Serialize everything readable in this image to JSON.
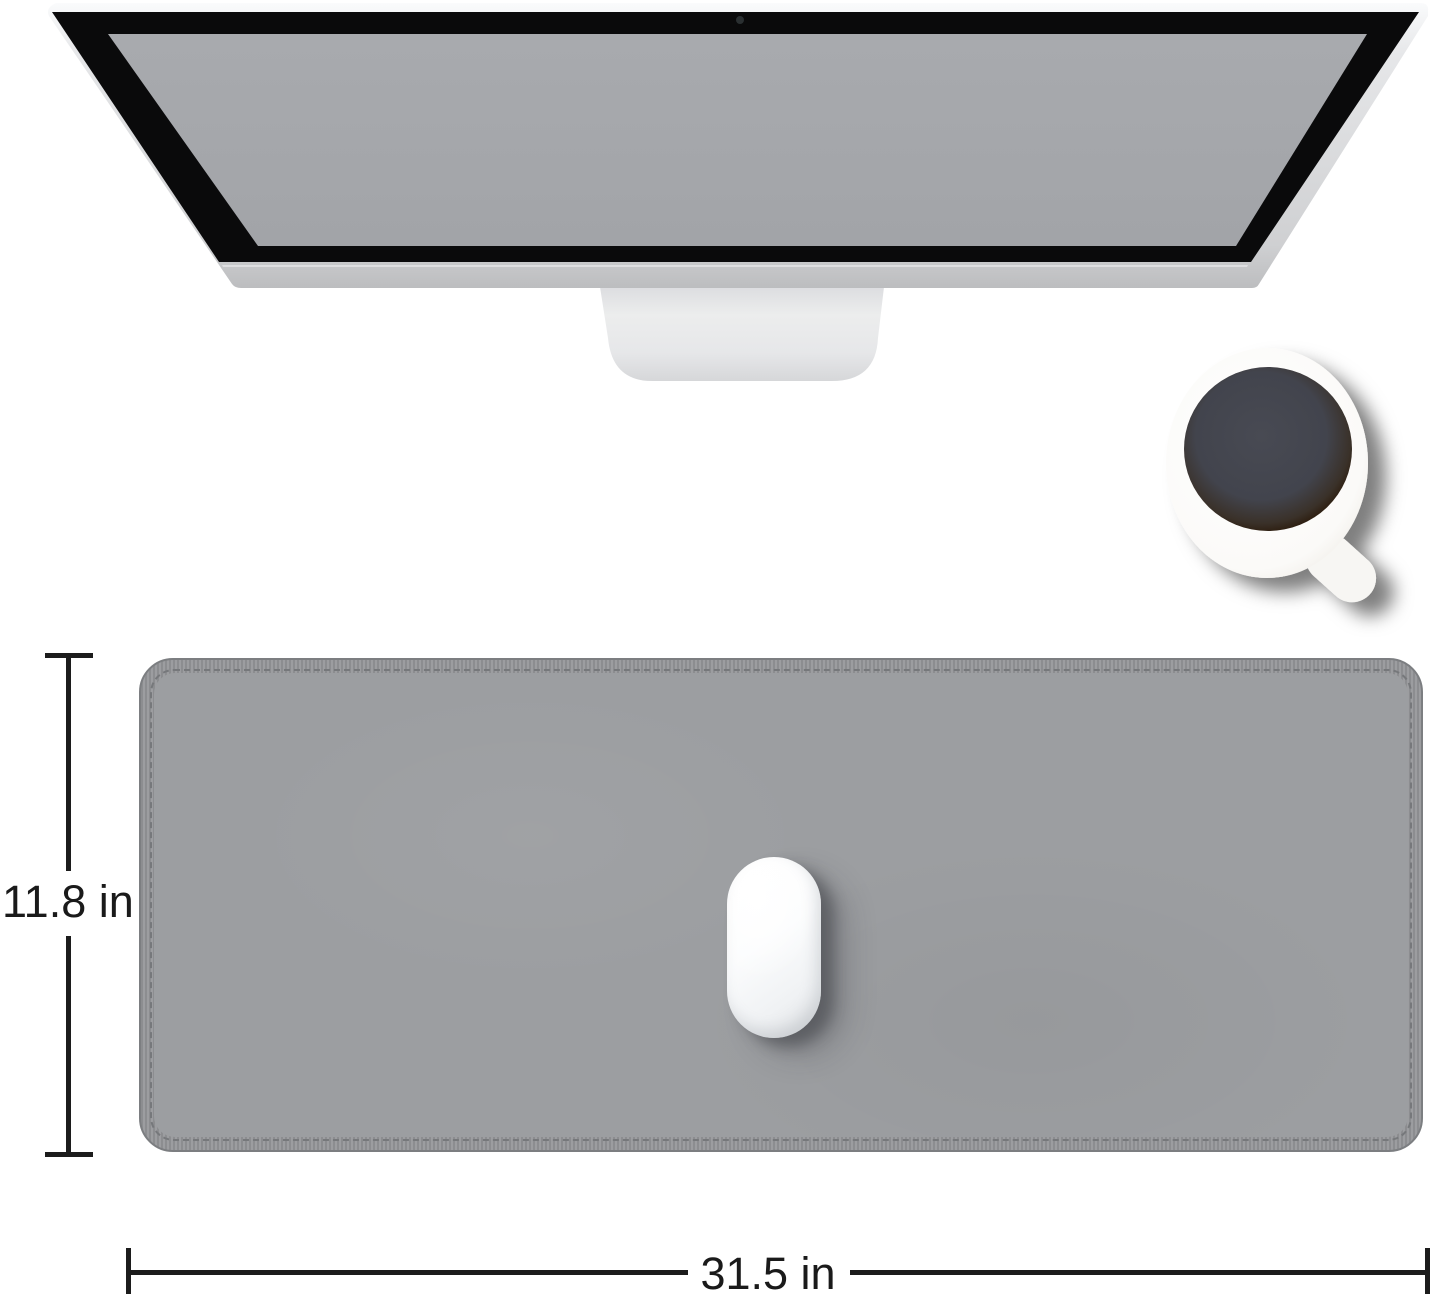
{
  "annotations": {
    "height_label": "11.8 in",
    "width_label": "31.5 in"
  },
  "colors": {
    "background": "#ffffff",
    "dimension_line": "#1c1c1c",
    "label_text": "#1a1a1a",
    "pad_surface": "#9c9ea1",
    "pad_band": "#97989b",
    "pad_edge": "#7c7e81",
    "screen_gray": "#a5a7ab",
    "bezel_black": "#0a0a0b",
    "monitor_silver": "#d9dadc",
    "stand_silver": "#e3e4e6",
    "coffee_dark": "#42444d",
    "mouse_white": "#ffffff"
  }
}
